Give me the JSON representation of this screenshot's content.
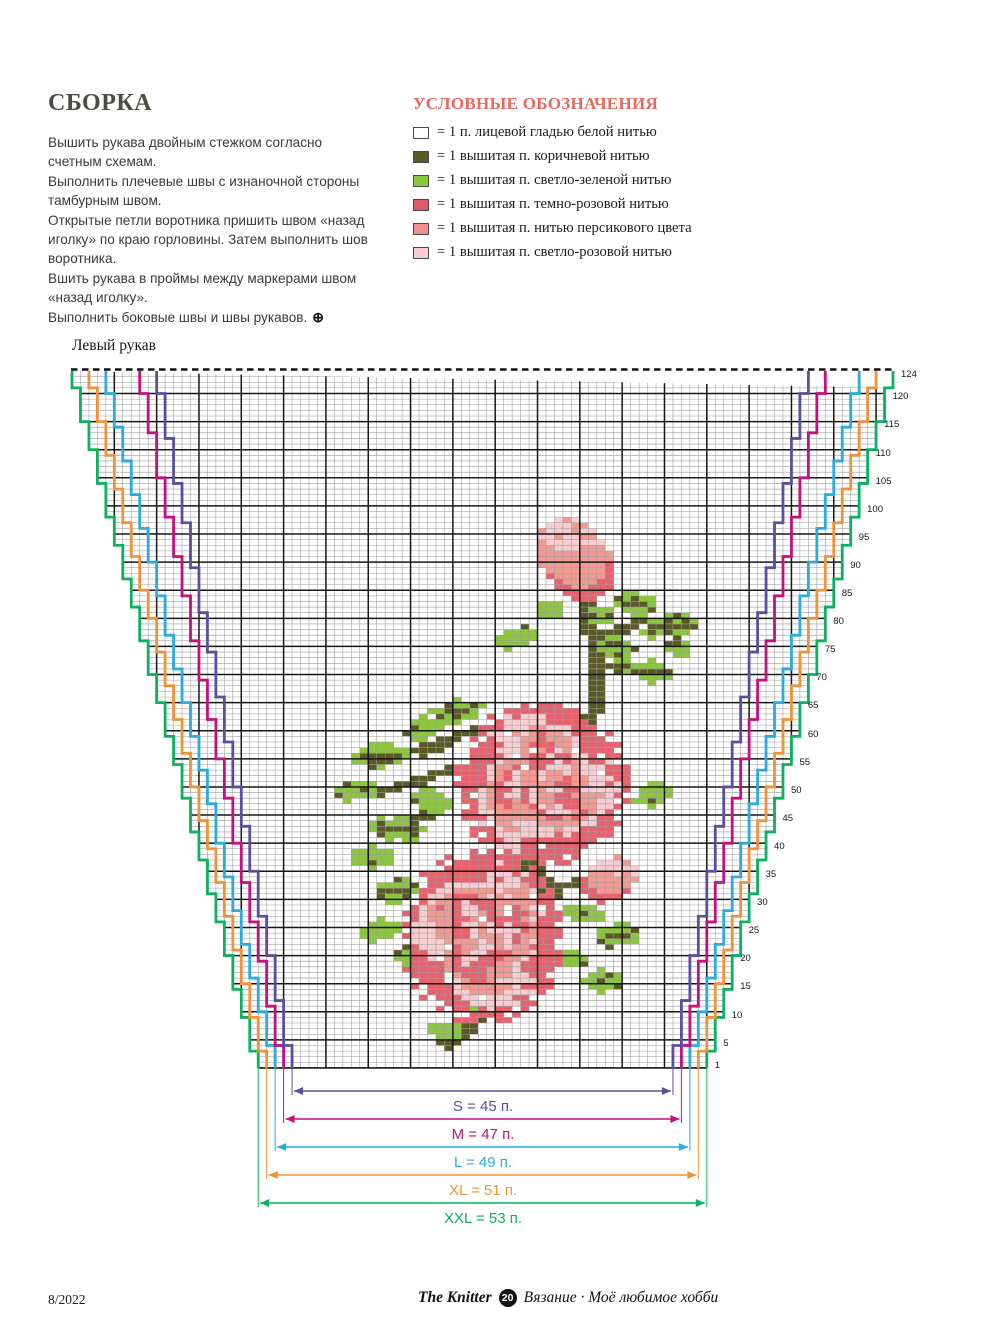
{
  "assembly": {
    "title": "СБОРКА",
    "lines": [
      "Вышить рукава двойным стежком согласно счетным схемам.",
      "Выполнить плечевые швы с изнаночной стороны тамбурным швом.",
      "Открытые петли воротника пришить швом «назад иголку» по краю горловины. Затем выполнить шов воротника.",
      "Вшить рукава в проймы между маркерами швом «назад иголку».",
      "Выполнить боковые швы и швы рукавов."
    ],
    "end_symbol": "⊕"
  },
  "legend": {
    "title": "УСЛОВНЫЕ ОБОЗНАЧЕНИЯ",
    "title_color": "#e8695c",
    "items": [
      {
        "swatch": "#ffffff",
        "label": "= 1 п. лицевой гладью белой нитью"
      },
      {
        "swatch": "#5a5a26",
        "label": "= 1 вышитая п. коричневой нитью"
      },
      {
        "swatch": "#8cc63f",
        "label": "= 1 вышитая п. светло-зеленой нитью"
      },
      {
        "swatch": "#e05a66",
        "label": "= 1 вышитая п. темно-розовой нитью"
      },
      {
        "swatch": "#ef8f92",
        "label": "= 1 вышитая п. нитью персикового цвета"
      },
      {
        "swatch": "#f7cbd0",
        "label": "= 1 вышитая п. светло-розовой нитью"
      }
    ]
  },
  "chart": {
    "title": "Левый рукав",
    "grid": {
      "cols": 97,
      "rows": 124,
      "cell_w": 8.464,
      "cell_h": 5.621,
      "x0": 72,
      "y0": 371,
      "thin_color": "#9a9a9a",
      "thick_color": "#161616",
      "bold_every": 5
    },
    "row_numbers": [
      124,
      120,
      115,
      110,
      105,
      100,
      95,
      90,
      85,
      80,
      75,
      70,
      65,
      60,
      55,
      50,
      45,
      40,
      35,
      30,
      25,
      20,
      15,
      10,
      5,
      1
    ],
    "sizes": [
      {
        "name": "S",
        "stitches": 45,
        "label": "S = 45 п.",
        "color": "#5b4ea0",
        "top_offset": 10,
        "bottom_offset": 26,
        "arrow_y": 1091
      },
      {
        "name": "M",
        "stitches": 47,
        "label": "M = 47 п.",
        "color": "#c40f7d",
        "top_offset": 8,
        "bottom_offset": 25,
        "arrow_y": 1119
      },
      {
        "name": "L",
        "stitches": 49,
        "label": "L = 49 п.",
        "color": "#2aabdf",
        "top_offset": 4,
        "bottom_offset": 24,
        "arrow_y": 1147
      },
      {
        "name": "XL",
        "stitches": 51,
        "label": "XL = 51 п.",
        "color": "#f0923a",
        "top_offset": 2,
        "bottom_offset": 23,
        "arrow_y": 1175
      },
      {
        "name": "XXL",
        "stitches": 53,
        "label": "XXL = 53 п.",
        "color": "#0cb05f",
        "top_offset": 0,
        "bottom_offset": 22,
        "arrow_y": 1203
      }
    ],
    "stitch_colors": {
      "B": "#5a5a26",
      "G": "#8cc63f",
      "D": "#e8626d",
      "P": "#f29992",
      "L": "#f8cdd2"
    },
    "motif_shapes": [
      {
        "type": "stem",
        "pts": [
          [
            60,
            41
          ],
          [
            61,
            50
          ],
          [
            61,
            58
          ],
          [
            59,
            66
          ]
        ]
      },
      {
        "type": "stem",
        "pts": [
          [
            61,
            47
          ],
          [
            66,
            44
          ]
        ]
      },
      {
        "type": "stem",
        "pts": [
          [
            61,
            52
          ],
          [
            67,
            52
          ]
        ]
      },
      {
        "type": "stem",
        "pts": [
          [
            47,
            63
          ],
          [
            40,
            67
          ]
        ]
      },
      {
        "type": "stem",
        "pts": [
          [
            44,
            70
          ],
          [
            36,
            74
          ]
        ]
      },
      {
        "type": "stem",
        "pts": [
          [
            38,
            80
          ],
          [
            43,
            77
          ]
        ]
      },
      {
        "type": "stem",
        "pts": [
          [
            53,
            87
          ],
          [
            56,
            93
          ]
        ]
      },
      {
        "type": "stem",
        "pts": [
          [
            56,
            91
          ],
          [
            61,
            90
          ]
        ]
      },
      {
        "type": "stem",
        "pts": [
          [
            50,
            111
          ],
          [
            46,
            116
          ],
          [
            43,
            119
          ]
        ]
      },
      {
        "type": "leaf",
        "c": 66,
        "t": 41,
        "rx": 3,
        "ry": 2,
        "rot": 20,
        "vein": true
      },
      {
        "type": "leaf",
        "c": 70,
        "t": 45,
        "rx": 3.2,
        "ry": 2.2,
        "rot": -15,
        "vein": true
      },
      {
        "type": "leaf",
        "c": 64,
        "t": 49,
        "rx": 2.6,
        "ry": 1.8,
        "rot": 45,
        "vein": false
      },
      {
        "type": "leaf",
        "c": 68,
        "t": 53,
        "rx": 3,
        "ry": 2,
        "rot": 0,
        "vein": true
      },
      {
        "type": "leaf",
        "c": 71,
        "t": 49,
        "rx": 2.2,
        "ry": 1.6,
        "rot": 70,
        "vein": false
      },
      {
        "type": "leaf",
        "c": 56,
        "t": 42,
        "rx": 2.2,
        "ry": 1.6,
        "rot": -40,
        "vein": false
      },
      {
        "type": "leaf",
        "c": 62,
        "t": 43,
        "rx": 2,
        "ry": 1.5,
        "rot": 30,
        "vein": false
      },
      {
        "type": "leaf",
        "c": 52,
        "t": 47,
        "rx": 2.8,
        "ry": 1.9,
        "rot": -25,
        "vein": false
      },
      {
        "type": "leaf",
        "c": 45,
        "t": 60,
        "rx": 3.5,
        "ry": 2.2,
        "rot": -20,
        "vein": true
      },
      {
        "type": "leaf",
        "c": 41,
        "t": 63,
        "rx": 2.8,
        "ry": 2,
        "rot": -40,
        "vein": false
      },
      {
        "type": "leaf",
        "c": 36,
        "t": 68,
        "rx": 3.2,
        "ry": 2.3,
        "rot": -10,
        "vein": true
      },
      {
        "type": "leaf",
        "c": 33,
        "t": 74,
        "rx": 2.8,
        "ry": 2.2,
        "rot": -35,
        "vein": false
      },
      {
        "type": "leaf",
        "c": 38,
        "t": 81,
        "rx": 3.2,
        "ry": 2.4,
        "rot": 15,
        "vein": true
      },
      {
        "type": "leaf",
        "c": 42,
        "t": 76,
        "rx": 2.6,
        "ry": 1.9,
        "rot": 35,
        "vein": false
      },
      {
        "type": "leaf",
        "c": 35,
        "t": 86,
        "rx": 2.6,
        "ry": 2,
        "rot": -15,
        "vein": false
      },
      {
        "type": "leaf",
        "c": 68,
        "t": 75,
        "rx": 2.5,
        "ry": 2,
        "rot": -30,
        "vein": false
      },
      {
        "type": "leaf",
        "c": 38,
        "t": 92,
        "rx": 2.8,
        "ry": 2.1,
        "rot": -20,
        "vein": true
      },
      {
        "type": "leaf",
        "c": 36,
        "t": 99,
        "rx": 2.6,
        "ry": 2,
        "rot": -45,
        "vein": false
      },
      {
        "type": "leaf",
        "c": 40,
        "t": 104,
        "rx": 2.6,
        "ry": 2,
        "rot": 20,
        "vein": false
      },
      {
        "type": "leaf",
        "c": 60,
        "t": 96,
        "rx": 2.5,
        "ry": 1.8,
        "rot": 20,
        "vein": false
      },
      {
        "type": "leaf",
        "c": 64,
        "t": 100,
        "rx": 3,
        "ry": 2.2,
        "rot": -20,
        "vein": true
      },
      {
        "type": "leaf",
        "c": 58,
        "t": 104,
        "rx": 2.4,
        "ry": 1.8,
        "rot": 35,
        "vein": false
      },
      {
        "type": "leaf",
        "c": 62,
        "t": 108,
        "rx": 2.8,
        "ry": 2,
        "rot": -10,
        "vein": false
      },
      {
        "type": "leaf",
        "c": 48,
        "t": 113,
        "rx": 2.5,
        "ry": 1.8,
        "rot": 25,
        "vein": false
      },
      {
        "type": "leaf",
        "c": 52,
        "t": 110,
        "rx": 2.4,
        "ry": 1.8,
        "rot": -25,
        "vein": false
      },
      {
        "type": "leaf",
        "c": 44,
        "t": 117,
        "rx": 2.4,
        "ry": 1.8,
        "rot": 10,
        "vein": false
      },
      {
        "type": "bud",
        "c": 59,
        "t": 33,
        "rx": 4.2,
        "ry": 7.5,
        "rot": -15
      },
      {
        "type": "bud",
        "c": 63,
        "t": 90,
        "rx": 3,
        "ry": 4.2,
        "rot": 20
      },
      {
        "type": "rose",
        "c": 55,
        "t": 73,
        "rx": 10,
        "ry": 14.5
      },
      {
        "type": "rose",
        "c": 48,
        "t": 100,
        "rx": 9.5,
        "ry": 15.5
      }
    ]
  },
  "footer": {
    "issue": "8/2022",
    "brand": "The Knitter",
    "badge": "20",
    "tagline": "Вязание · Моё любимое хобби"
  }
}
